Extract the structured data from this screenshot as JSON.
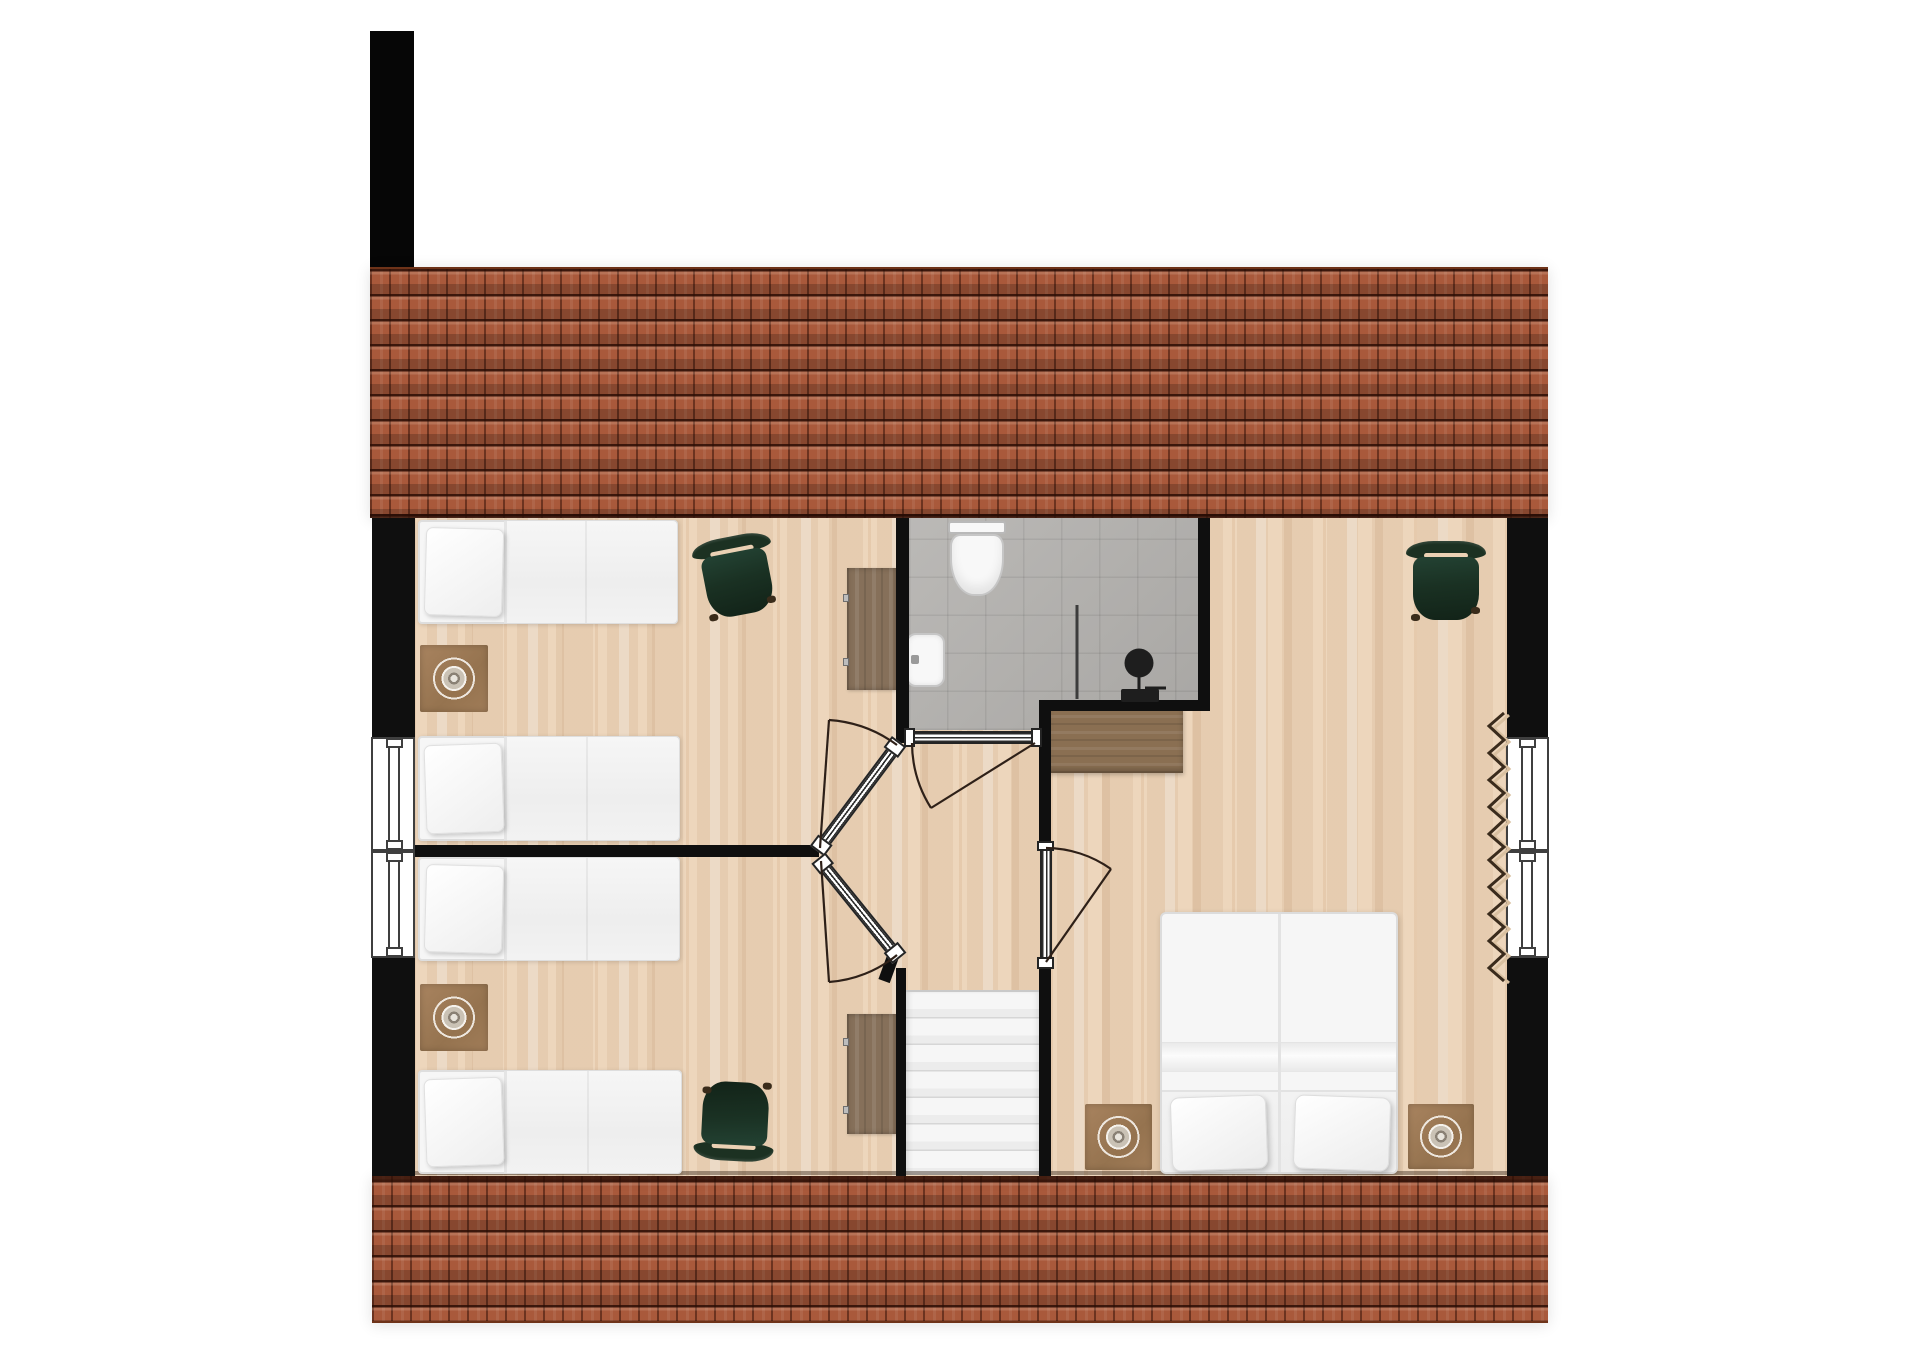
{
  "document": {
    "type": "floor-plan",
    "view": "top-down 2D render",
    "level": "upper floor",
    "visible_text": ""
  },
  "palette": {
    "background": "#ffffff",
    "wall": "#0f0f0f",
    "roof": "#a9593b",
    "roof_dark": "#48200e",
    "floor_wood": "#ebd1b4",
    "bathroom_tile": "#b3b1ae",
    "furniture_wood": "#86705a",
    "counter_wood": "#8a6f52",
    "bed_white": "#f6f6f6",
    "chair_green": "#1c3122",
    "stairs_white": "#f2f2f2",
    "stair_line": "#d6d6d6",
    "door_line": "#2e2018",
    "window_frame": "#3f3f3f",
    "rug_brown": "#a07c58",
    "fixture_dark": "#1e1e1e",
    "porcelain": "#f8f8f8"
  },
  "structure": {
    "roof_sections": 2,
    "chimney": 1,
    "exterior_windows": 4,
    "interior_doors": 4,
    "staircase": {
      "steps_visible": 7,
      "location": "center-bottom of hallway"
    }
  },
  "rooms": [
    {
      "name": "bedroom-top-left",
      "floor": "wood",
      "furniture": [
        "single bed",
        "single bed",
        "bedside rug with lamp",
        "dresser desk",
        "green chair"
      ]
    },
    {
      "name": "bedroom-bottom-left",
      "floor": "wood",
      "furniture": [
        "single bed",
        "single bed",
        "bedside rug with lamp",
        "dresser desk",
        "green chair"
      ]
    },
    {
      "name": "bathroom",
      "floor": "gray tile",
      "fixtures": [
        "toilet",
        "washbasin",
        "walk-in shower with glass screen and rain head"
      ]
    },
    {
      "name": "hallway-landing",
      "floor": "wood",
      "features": [
        "staircase down",
        "two angled bedroom doors",
        "bathroom door"
      ]
    },
    {
      "name": "bedroom-right-master",
      "floor": "wood",
      "furniture": [
        "double bed",
        "bedside rug with lamp",
        "bedside rug with lamp",
        "green chair",
        "sideboard",
        "radiator"
      ]
    }
  ],
  "counts": {
    "single_beds": 4,
    "double_beds": 1,
    "chairs": 3,
    "bedside_rugs": 4,
    "desks": 2,
    "sideboards": 1,
    "radiators": 1
  }
}
